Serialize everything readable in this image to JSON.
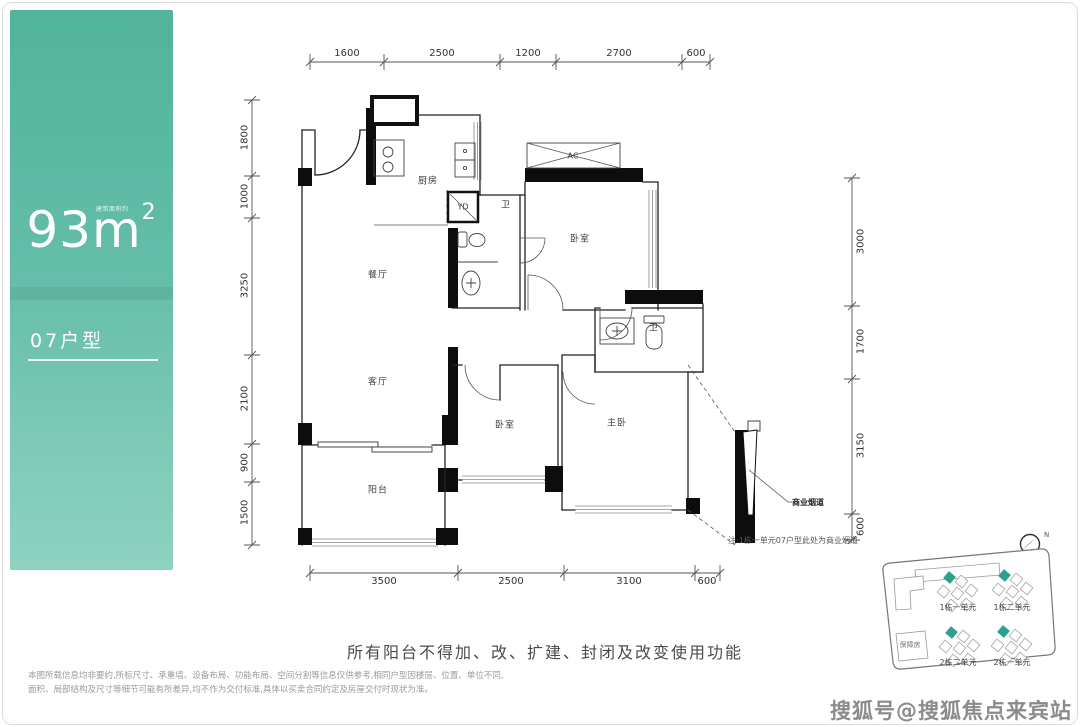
{
  "panel": {
    "area_small_label": "建筑面积约",
    "area_value": "93m",
    "area_sup": "2",
    "unit_label": "07户型"
  },
  "plan": {
    "dims_top": [
      "1600",
      "2500",
      "1200",
      "2700",
      "600"
    ],
    "dims_left": [
      "1800",
      "1000",
      "3250",
      "2100",
      "900",
      "1500"
    ],
    "dims_right": [
      "3000",
      "1700",
      "3150",
      "600"
    ],
    "dims_bottom": [
      "3500",
      "2500",
      "3100",
      "600"
    ],
    "rooms": {
      "kitchen": "厨房",
      "dining": "餐厅",
      "living": "客厅",
      "balcony": "阳台",
      "bedroom_top": "卧室",
      "bedroom_mid": "卧室",
      "master": "主卧",
      "bath1": "卫",
      "bath2": "卫",
      "yd": "YD",
      "ac": "AC"
    },
    "flue_label": "商业烟道",
    "note": "注:1栋一单元07户型此处为商业烟道"
  },
  "sitemap": {
    "labels": [
      "1栋一单元",
      "1栋二单元",
      "2栋二单元",
      "2栋一单元"
    ],
    "support_label": "保障房",
    "north_label": "N",
    "highlight_color": "#2f9f8f"
  },
  "footer": {
    "balcony_notice": "所有阳台不得加、改、扩建、封闭及改变使用功能",
    "disclaimer_line1": "本图所载信息均非要约,所标尺寸、承重墙、设备布局、功能布局、空间分割等信息仅供参考,相同户型因楼层、位置、单位不同,",
    "disclaimer_line2": "面积、局部结构及尺寸等细节可能有所差异,均不作为交付标准,具体以买卖合同约定及房屋交付时现状为准。",
    "watermark": "搜狐号@搜狐焦点来宾站"
  },
  "colors": {
    "panel_top": "#52b49b",
    "panel_bottom": "#8fd2c1",
    "wall": "#232323",
    "highlight": "#2f9f8f"
  }
}
